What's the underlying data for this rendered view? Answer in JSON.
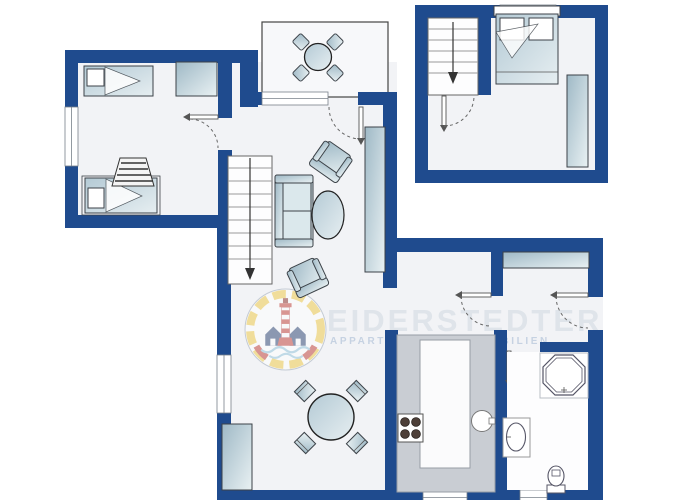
{
  "watermark": {
    "brand": "EIDERSTEDTER",
    "subtitle": "APPARTEMENTS & IMMOBILIEN"
  },
  "colors": {
    "wall": "#1f4b8e",
    "floor": "#f2f3f6",
    "counter": "#c9cdd3",
    "furniture_dark": "#9fb9c6",
    "furniture_light": "#e9f1f3",
    "watermark_text": "#dfe4ea",
    "watermark_subtext": "#c6d2e2",
    "logo_yellow": "#f0c840",
    "logo_red": "#c03a30",
    "logo_navy": "#27406e",
    "logo_water": "#8fc3d9"
  }
}
